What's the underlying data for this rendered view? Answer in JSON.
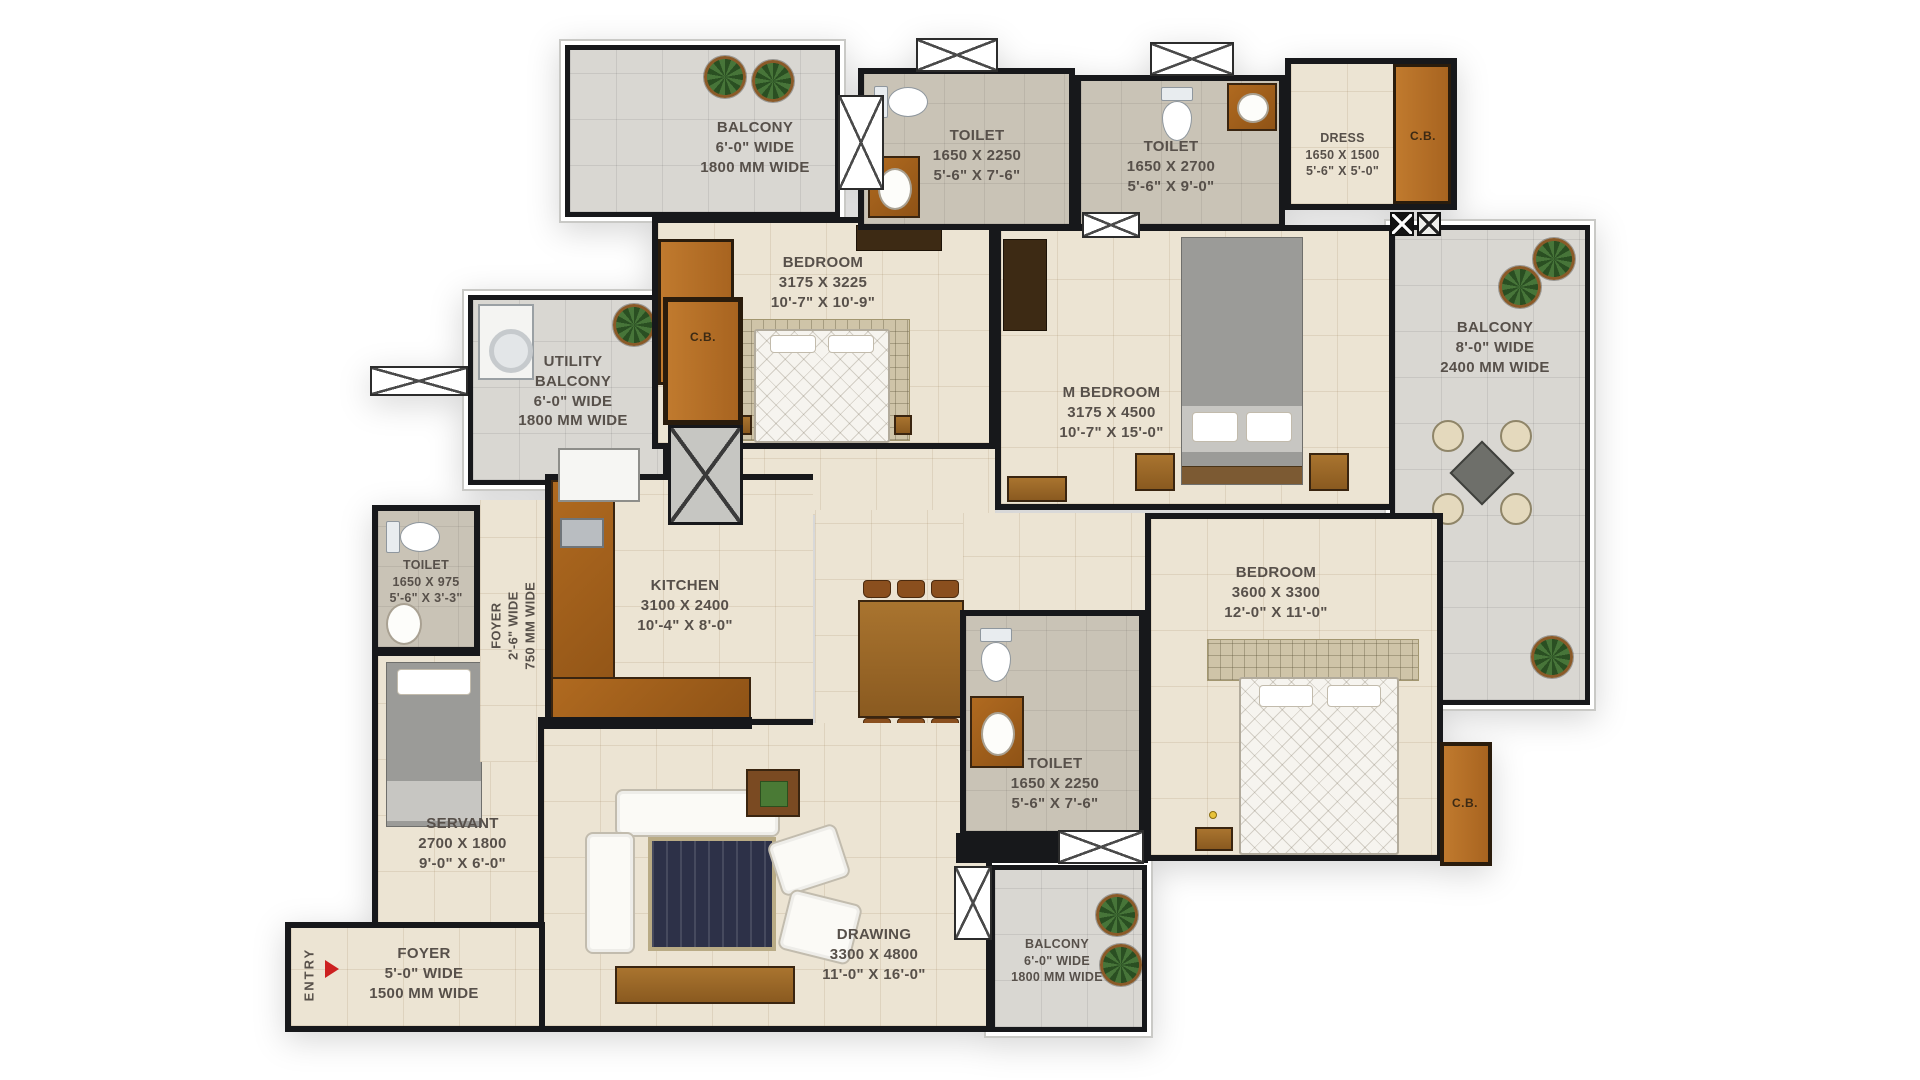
{
  "colors": {
    "wall": "#17181b",
    "floor-cream": "#ece4d3",
    "floor-gray": "#d9d7d2",
    "floor-toilet": "#c9c3b6",
    "wood": "#b96f28",
    "wood-dark": "#4c2f15",
    "label": "#57504a",
    "accent-red": "#cc2020"
  },
  "rooms": {
    "balcony_top": {
      "lines": [
        "BALCONY",
        "6'-0\" WIDE",
        "1800 MM WIDE"
      ]
    },
    "toilet_1": {
      "lines": [
        "TOILET",
        "1650 X 2250",
        "5'-6\" X 7'-6\""
      ]
    },
    "toilet_2": {
      "lines": [
        "TOILET",
        "1650 X 2700",
        "5'-6\" X 9'-0\""
      ]
    },
    "dress": {
      "lines": [
        "DRESS",
        "1650 X 1500",
        "5'-6\" X 5'-0\""
      ]
    },
    "cb_dress": {
      "label": "C.B."
    },
    "bedroom_1": {
      "lines": [
        "BEDROOM",
        "3175 X 3225",
        "10'-7\" X 10'-9\""
      ]
    },
    "cb_bedroom_1": {
      "label": "C.B."
    },
    "m_bedroom": {
      "lines": [
        "M BEDROOM",
        "3175 X 4500",
        "10'-7\" X 15'-0\""
      ]
    },
    "balcony_right": {
      "lines": [
        "BALCONY",
        "8'-0\" WIDE",
        "2400 MM WIDE"
      ]
    },
    "utility_balcony": {
      "lines": [
        "UTILITY",
        "BALCONY",
        "6'-0\" WIDE",
        "1800 MM WIDE"
      ]
    },
    "cb_utility": {
      "label": "C.B."
    },
    "toilet_3": {
      "lines": [
        "TOILET",
        "1650 X 975",
        "5'-6\" X 3'-3\""
      ]
    },
    "foyer_passage": {
      "lines": [
        "FOYER",
        "2'-6\" WIDE",
        "750 MM WIDE"
      ]
    },
    "kitchen": {
      "lines": [
        "KITCHEN",
        "3100 X 2400",
        "10'-4\" X 8'-0\""
      ]
    },
    "servant": {
      "lines": [
        "SERVANT",
        "2700 X 1800",
        "9'-0\" X 6'-0\""
      ]
    },
    "dining": {
      "lines": [
        "DINING",
        "2575 X 2400",
        "8'-7\" X 8'-0\""
      ]
    },
    "toilet_4": {
      "lines": [
        "TOILET",
        "1650 X 2250",
        "5'-6\" X 7'-6\""
      ]
    },
    "bedroom_2": {
      "lines": [
        "BEDROOM",
        "3600 X 3300",
        "12'-0\" X 11'-0\""
      ]
    },
    "cb_bedroom_2": {
      "label": "C.B."
    },
    "drawing": {
      "lines": [
        "DRAWING",
        "3300 X 4800",
        "11'-0\" X 16'-0\""
      ]
    },
    "foyer_entry": {
      "lines": [
        "FOYER",
        "5'-0\" WIDE",
        "1500 MM WIDE"
      ]
    },
    "balcony_bottom": {
      "lines": [
        "BALCONY",
        "6'-0\" WIDE",
        "1800 MM WIDE"
      ]
    },
    "entry": {
      "label": "ENTRY"
    }
  }
}
